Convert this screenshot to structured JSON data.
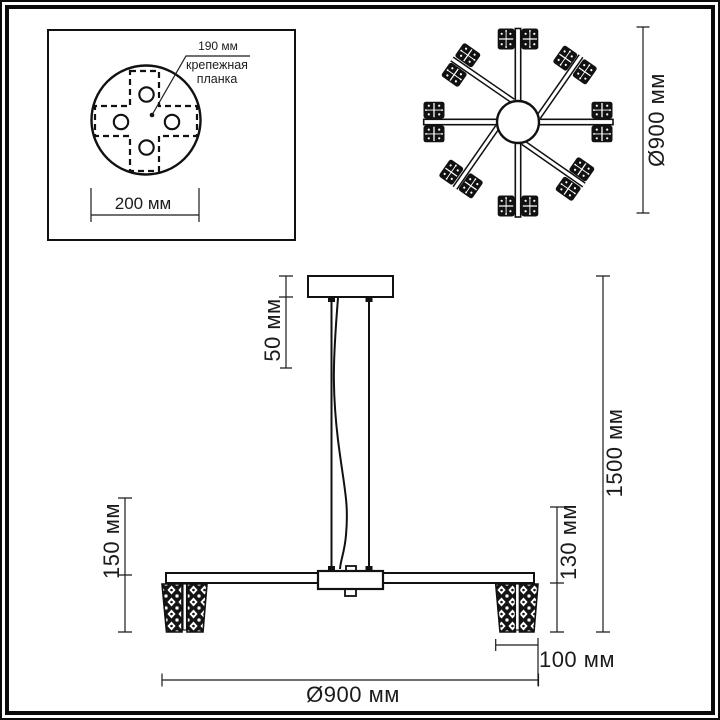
{
  "figure": {
    "inset": {
      "dim_plate": "190 мм",
      "plate_label": "крепежная планка",
      "dim_base": "200 мм"
    },
    "top_view": {
      "dim_diameter": "Ø900 мм"
    },
    "front_view": {
      "dim_canopy": "50 мм",
      "dim_drop_left": "150 мм",
      "dim_shade_height": "130 мм",
      "dim_total_height": "1500 мм",
      "dim_shade_width": "100 мм",
      "dim_width": "Ø900 мм"
    }
  },
  "colors": {
    "ink": "#1b1b1b",
    "paper": "#ffffff"
  }
}
